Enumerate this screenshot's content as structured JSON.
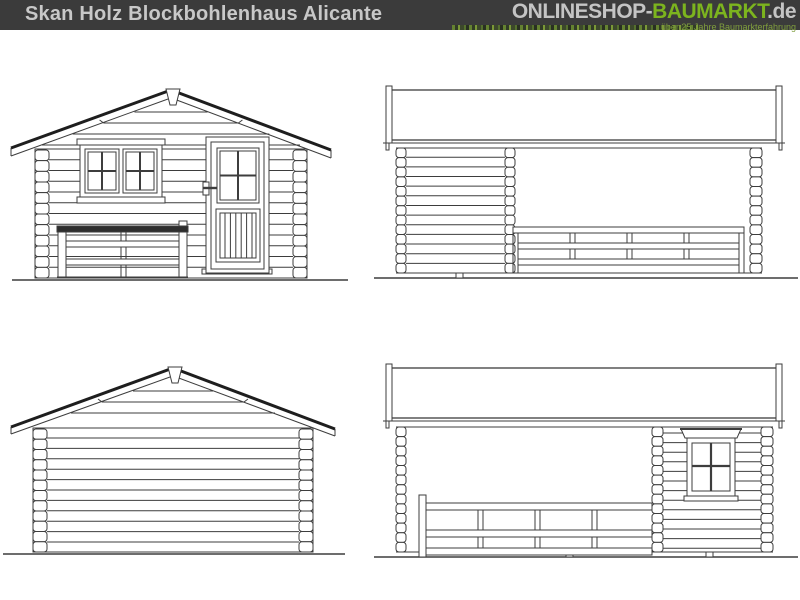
{
  "header": {
    "title": "Skan Holz Blockbohlenhaus Alicante",
    "logo": {
      "part1": "ONLINESHOP-",
      "part2": "BAUMARKT",
      "suffix": ".de",
      "tagline": "über 25 Jahre Baumarkterfahrung"
    },
    "colors": {
      "bar_bg": "#3b3b3b",
      "title_text": "#c8c8c8",
      "logo_gray": "#c4c4c4",
      "logo_green": "#7cb41e",
      "tagline_green": "#7f9e3d"
    }
  },
  "drawing": {
    "background": "#ffffff",
    "line_color": "#3d3d3d",
    "roof_edge_color": "#1e1e1e",
    "railing_bar_color": "#2e2e2e",
    "views": [
      "front-elevation",
      "side-elevation-terrace",
      "rear-elevation",
      "side-elevation-window"
    ]
  }
}
